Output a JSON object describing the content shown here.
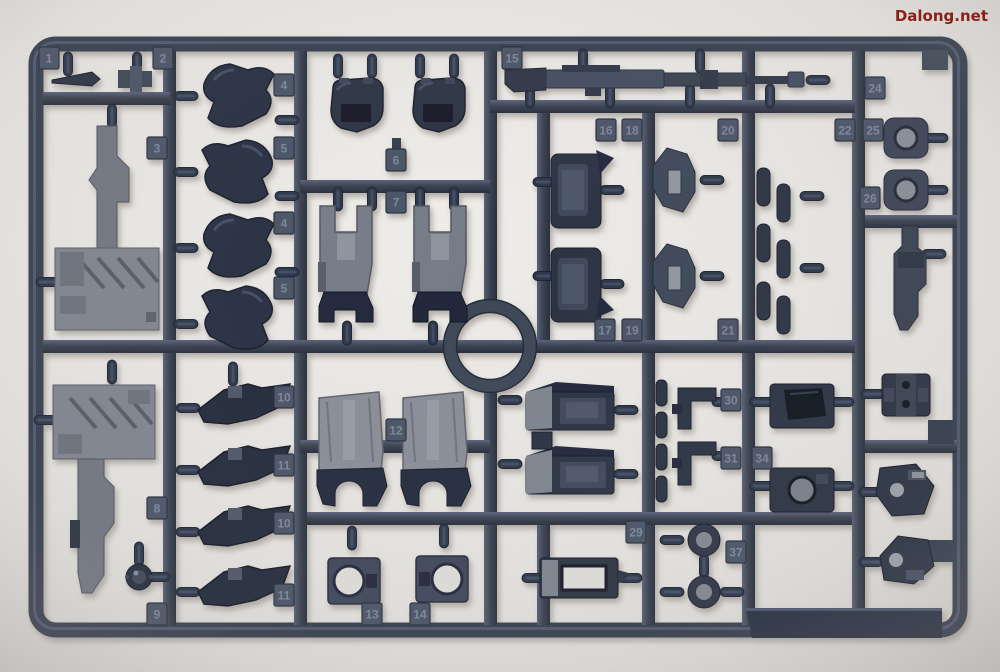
{
  "watermark": {
    "text": "Dalong.net",
    "color": "#8a2016"
  },
  "scene": {
    "subject": "gunpla-model-kit-runner-sprue-photo",
    "background_color": "#e8e6e3",
    "plastic_color_dark": "#262c3c",
    "plastic_color_mid": "#3a4254",
    "plastic_color_light": "#868b95"
  },
  "runner": {
    "part_tags": [
      {
        "label": "1",
        "x": 49,
        "y": 58
      },
      {
        "label": "2",
        "x": 163,
        "y": 58
      },
      {
        "label": "3",
        "x": 157,
        "y": 148
      },
      {
        "label": "4",
        "x": 284,
        "y": 85
      },
      {
        "label": "5",
        "x": 284,
        "y": 148
      },
      {
        "label": "4",
        "x": 284,
        "y": 223
      },
      {
        "label": "5",
        "x": 284,
        "y": 288
      },
      {
        "label": "6",
        "x": 396,
        "y": 160
      },
      {
        "label": "7",
        "x": 396,
        "y": 202
      },
      {
        "label": "8",
        "x": 157,
        "y": 508
      },
      {
        "label": "9",
        "x": 157,
        "y": 614
      },
      {
        "label": "10",
        "x": 284,
        "y": 397
      },
      {
        "label": "11",
        "x": 284,
        "y": 465
      },
      {
        "label": "10",
        "x": 284,
        "y": 523
      },
      {
        "label": "11",
        "x": 284,
        "y": 595
      },
      {
        "label": "12",
        "x": 396,
        "y": 430
      },
      {
        "label": "13",
        "x": 372,
        "y": 614
      },
      {
        "label": "14",
        "x": 420,
        "y": 614
      },
      {
        "label": "15",
        "x": 512,
        "y": 58
      },
      {
        "label": "16",
        "x": 606,
        "y": 130
      },
      {
        "label": "18",
        "x": 632,
        "y": 130
      },
      {
        "label": "20",
        "x": 728,
        "y": 130
      },
      {
        "label": "17",
        "x": 605,
        "y": 330
      },
      {
        "label": "19",
        "x": 632,
        "y": 330
      },
      {
        "label": "21",
        "x": 728,
        "y": 330
      },
      {
        "label": "22",
        "x": 845,
        "y": 130
      },
      {
        "label": "24",
        "x": 875,
        "y": 88
      },
      {
        "label": "25",
        "x": 873,
        "y": 130
      },
      {
        "label": "26",
        "x": 870,
        "y": 198
      },
      {
        "label": "29",
        "x": 636,
        "y": 532
      },
      {
        "label": "30",
        "x": 731,
        "y": 400
      },
      {
        "label": "31",
        "x": 731,
        "y": 458
      },
      {
        "label": "34",
        "x": 762,
        "y": 458
      },
      {
        "label": "37",
        "x": 736,
        "y": 552
      }
    ]
  }
}
